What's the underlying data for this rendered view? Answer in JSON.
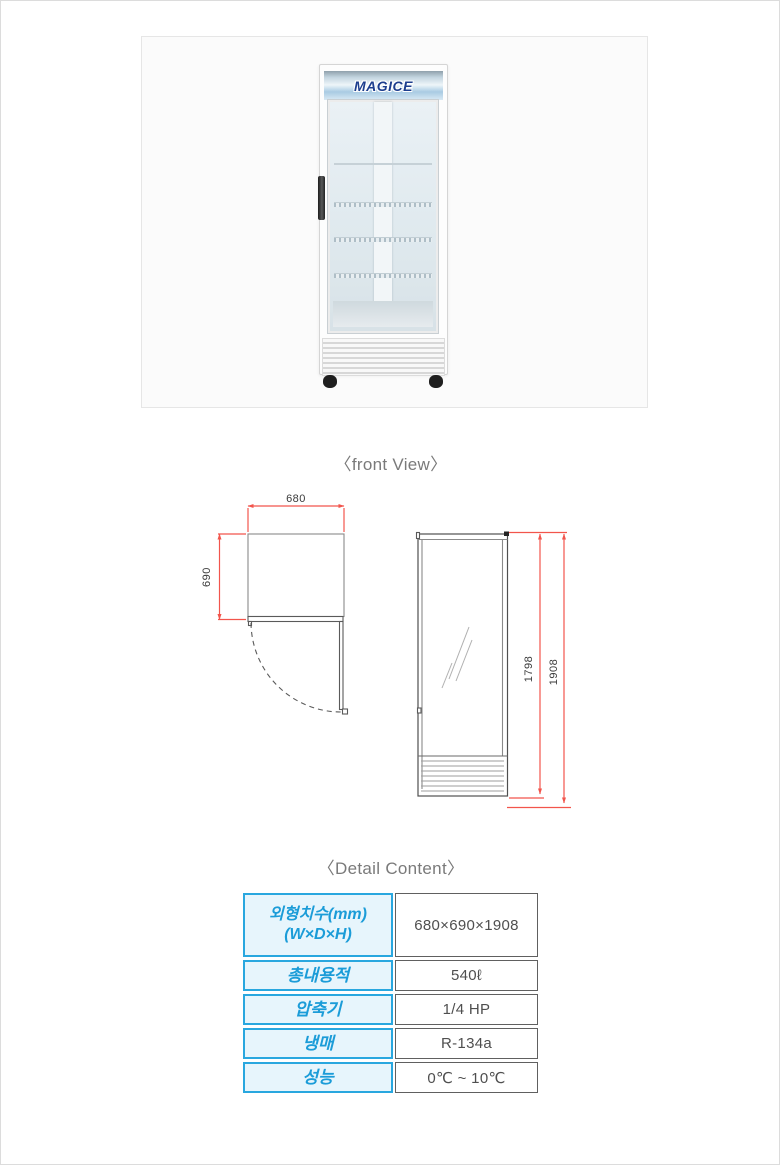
{
  "product": {
    "brand": "MAGICE",
    "type": "single glass door showcase refrigerator"
  },
  "labels": {
    "front_view": "〈front View〉",
    "detail_content": "〈Detail Content〉"
  },
  "drawings": {
    "top_view": {
      "width_mm": "680",
      "depth_mm": "690"
    },
    "front_view": {
      "inner_height_mm": "1798",
      "overall_height_mm": "1908"
    },
    "dimension_line_color": "#f2554c",
    "outline_color": "#8a8a8a",
    "dimension_text_color": "#3b3b3b"
  },
  "spec_table": {
    "accent_border_color": "#29a7df",
    "accent_bg_color": "#e7f5fc",
    "accent_text_color": "#1b9cd8",
    "value_text_color": "#4f4f4f",
    "rows": [
      {
        "label": "외형치수(mm)",
        "sublabel": "(W×D×H)",
        "value": "680×690×1908"
      },
      {
        "label": "총내용적",
        "value": "540ℓ"
      },
      {
        "label": "압축기",
        "value": "1/4 HP"
      },
      {
        "label": "냉매",
        "value": "R-134a"
      },
      {
        "label": "성능",
        "value": "0℃ ~ 10℃"
      }
    ]
  }
}
